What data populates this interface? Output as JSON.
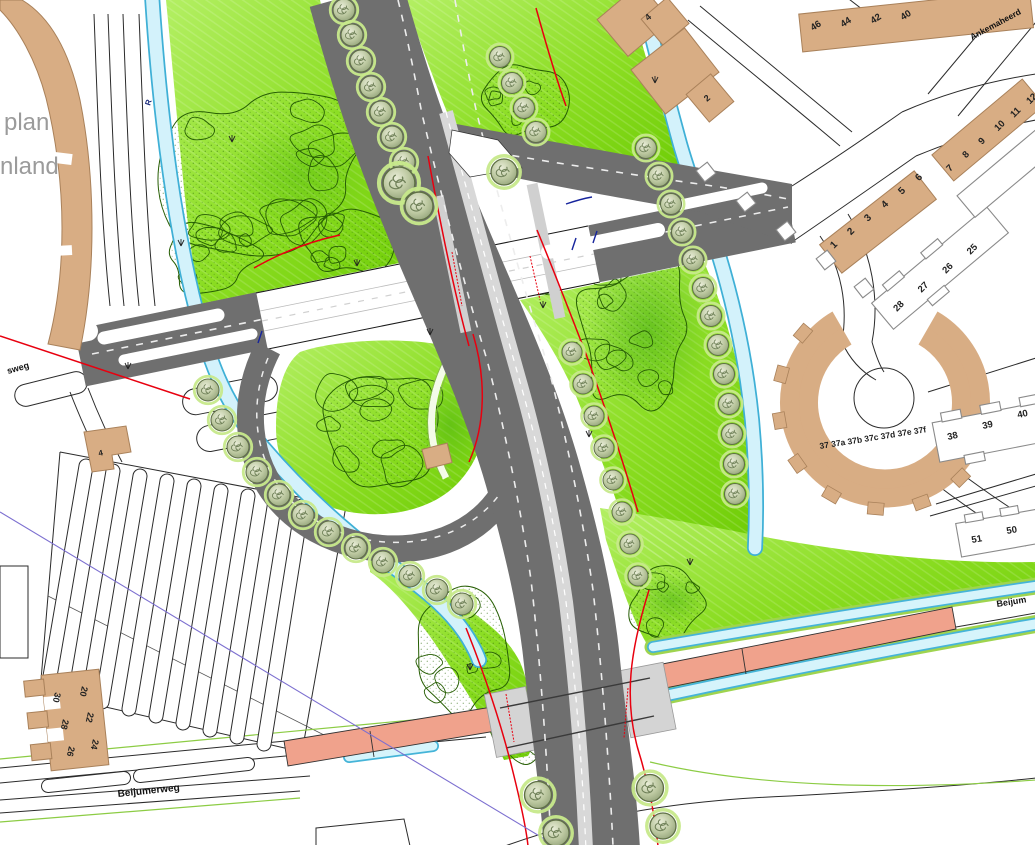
{
  "title": "road interchange site plan",
  "labels": {
    "area_partial_1": "plan",
    "area_partial_2": "nland",
    "street_sweg": "sweg",
    "street_beijumerweg": "Beijumerweg",
    "street_beijum_right": "Beijum",
    "street_ankemaheerd": "Ankemaheerd",
    "water_r": "R"
  },
  "house_numbers": {
    "top_block": [
      "46",
      "44",
      "42",
      "40"
    ],
    "block_7_12": [
      "7",
      "8",
      "9",
      "10",
      "11",
      "12"
    ],
    "block_1_6": [
      "1",
      "2",
      "3",
      "4",
      "5",
      "6"
    ],
    "block_25_28": [
      "28",
      "27",
      "26",
      "25"
    ],
    "block_37": "37 37a 37b 37c 37d 37e 37f",
    "block_38_40": [
      "38",
      "39",
      "40"
    ],
    "block_50_51": [
      "51",
      "50"
    ],
    "single_4_ne": "4",
    "single_2_ne": "2",
    "single_4_w": "4",
    "block_e_left": [
      "30",
      "28",
      "26"
    ],
    "block_e_right": [
      "20",
      "22",
      "24"
    ]
  },
  "colors": {
    "grass_light": "#a7ea52",
    "grass_dark": "#74d309",
    "scribble_green": "#275e04",
    "water_fill": "#d3f2fb",
    "water_edge": "#3fb0d6",
    "bank_green": "#9fd44f",
    "road_gray": "#6f6f6f",
    "median_gray": "#d8d8d8",
    "building_tan": "#d8ad84",
    "salmon_road": "#f0a28c",
    "accent_red": "#e8000f",
    "accent_blue": "#16249c",
    "accent_purple": "#7c6fd0",
    "label_gray": "#9b9b9b"
  }
}
